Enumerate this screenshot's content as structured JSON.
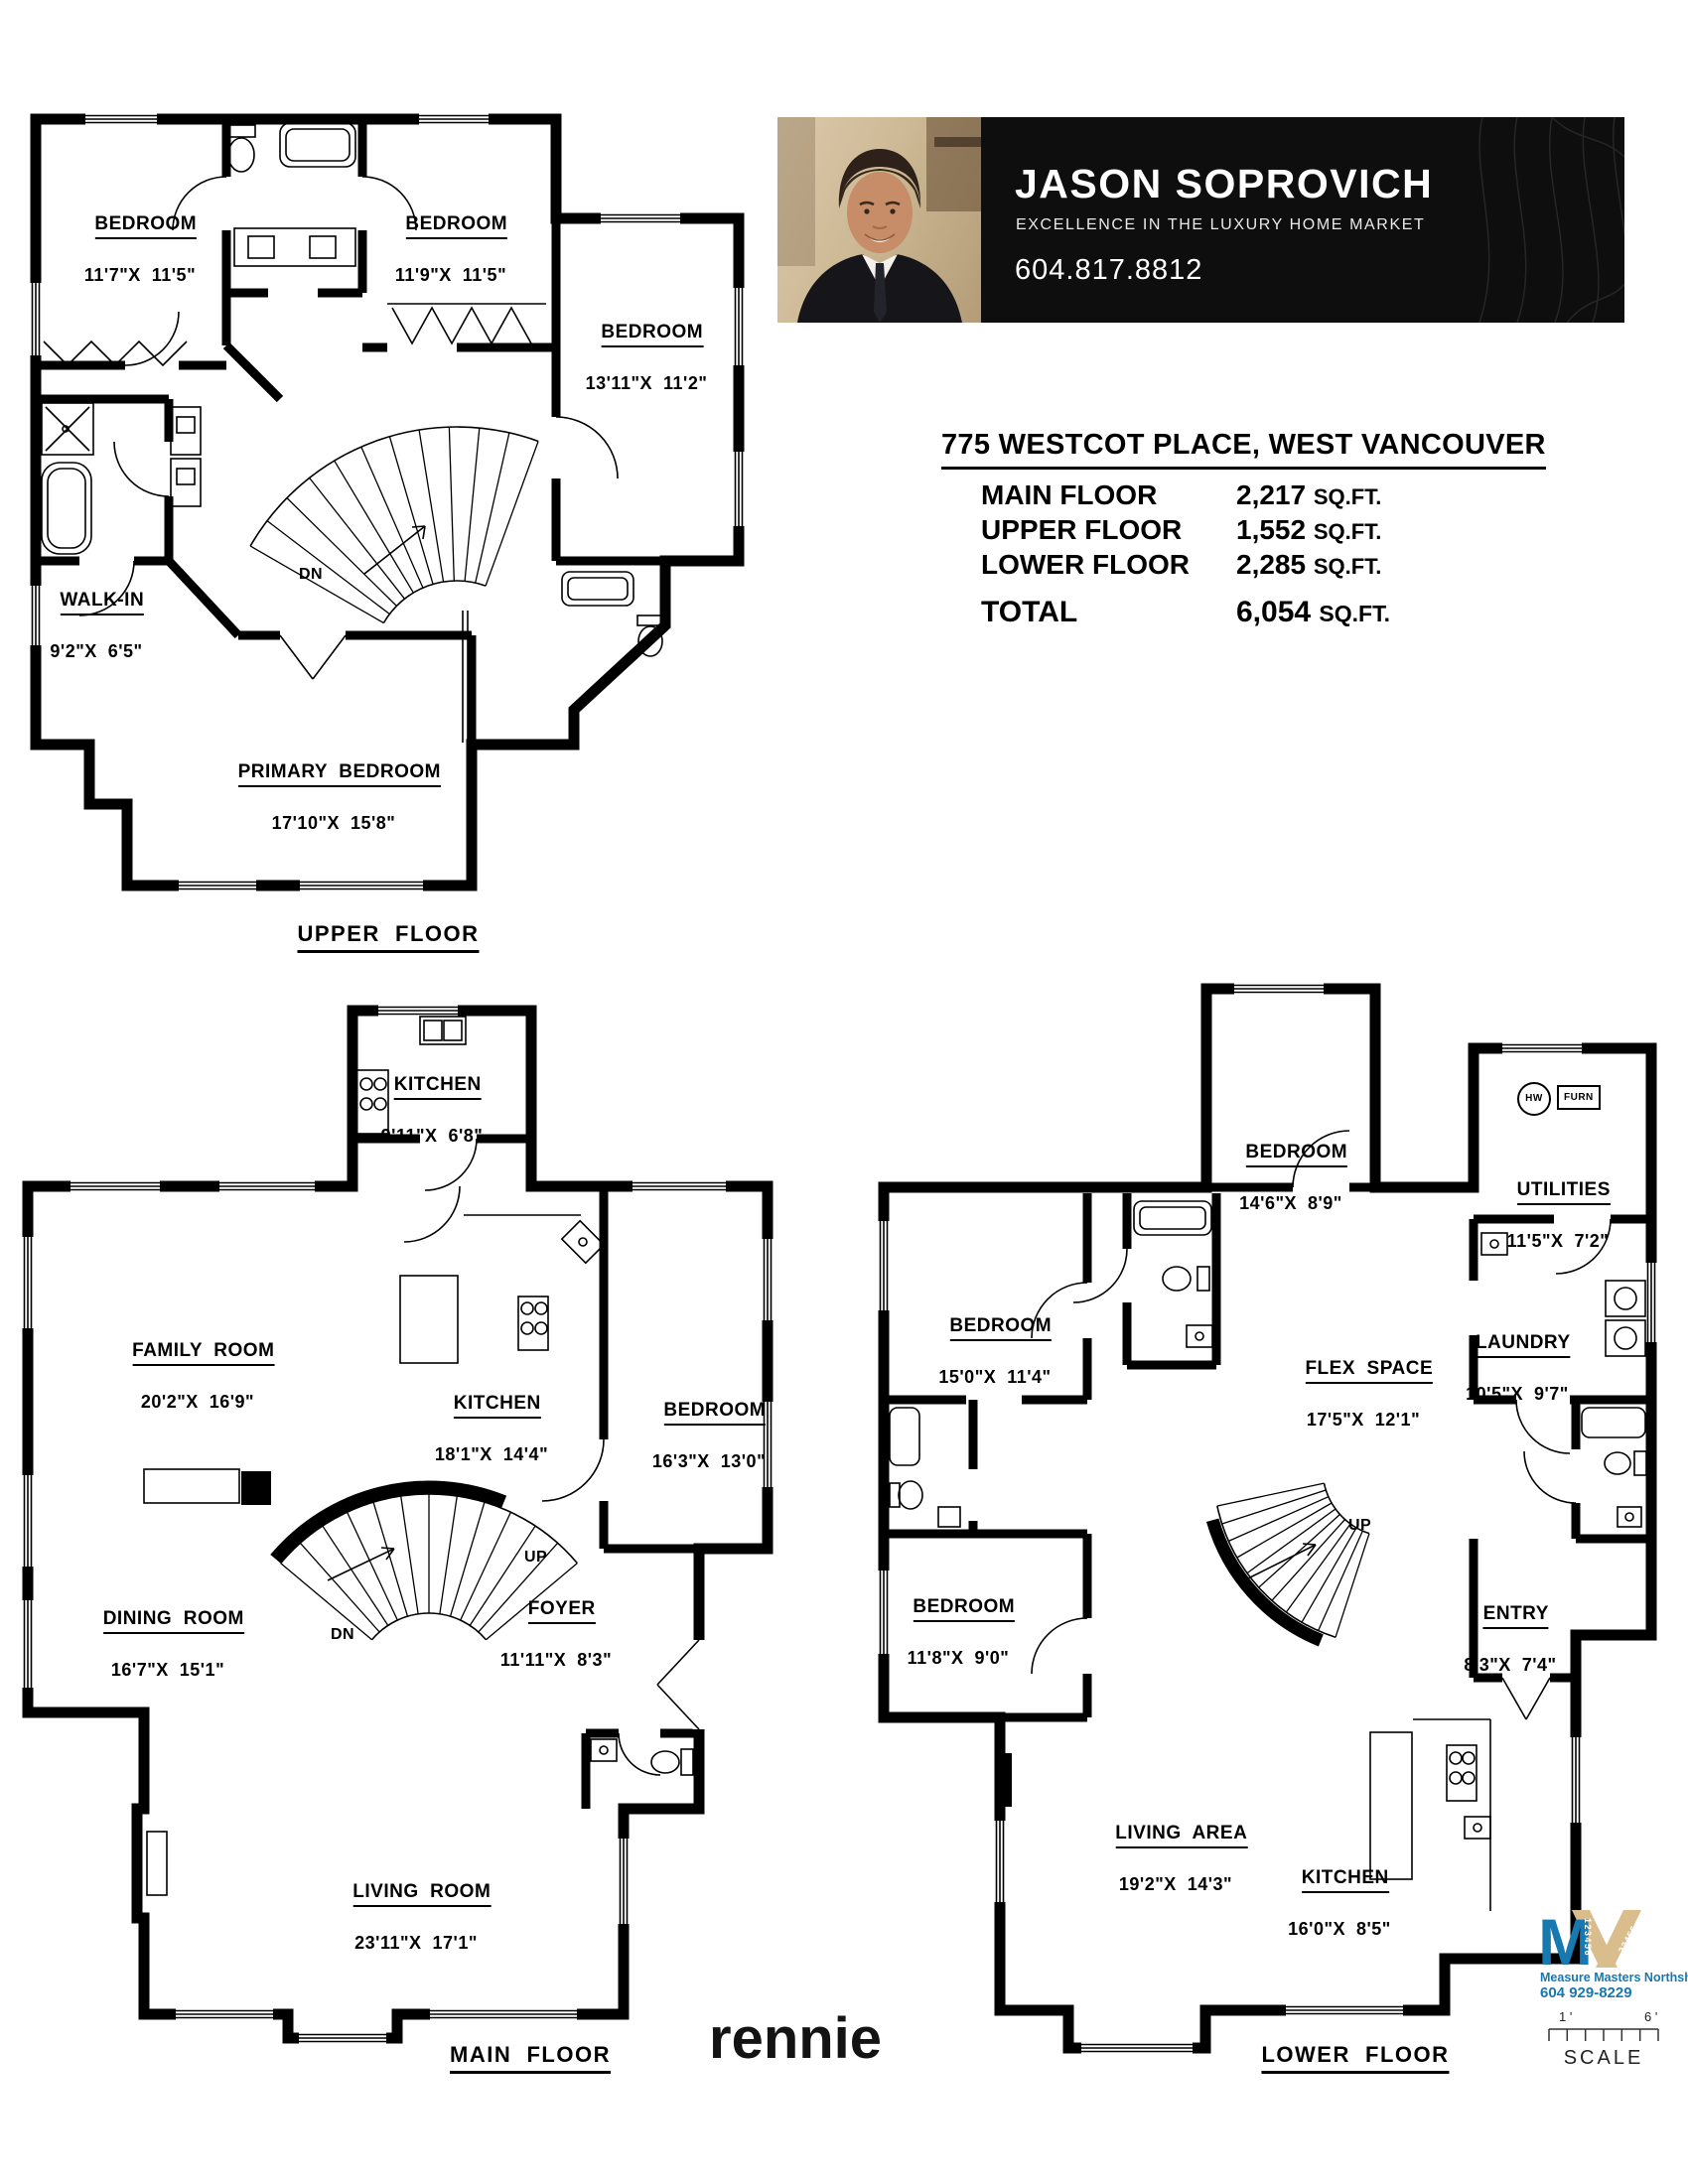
{
  "banner": {
    "name": "JASON SOPROVICH",
    "tagline": "EXCELLENCE IN THE LUXURY HOME MARKET",
    "phone": "604.817.8812"
  },
  "property": {
    "address": "775 WESTCOT PLACE, WEST VANCOUVER",
    "areas": [
      {
        "label": "MAIN FLOOR",
        "value": "2,217",
        "unit": "SQ.FT."
      },
      {
        "label": "UPPER FLOOR",
        "value": "1,552",
        "unit": "SQ.FT."
      },
      {
        "label": "LOWER FLOOR",
        "value": "2,285",
        "unit": "SQ.FT."
      }
    ],
    "total": {
      "label": "TOTAL",
      "value": "6,054",
      "unit": "SQ.FT."
    }
  },
  "floors": {
    "upper": {
      "caption": "UPPER  FLOOR",
      "dn": "DN",
      "rooms": [
        {
          "label": "BEDROOM",
          "dims": "11'7\"X  11'5\""
        },
        {
          "label": "BEDROOM",
          "dims": "11'9\"X  11'5\""
        },
        {
          "label": "BEDROOM",
          "dims": "13'11\"X  11'2\""
        },
        {
          "label": "WALK-IN",
          "dims": "9'2\"X  6'5\""
        },
        {
          "label": "PRIMARY  BEDROOM",
          "dims": "17'10\"X  15'8\""
        }
      ]
    },
    "main": {
      "caption": "MAIN  FLOOR",
      "up": "UP",
      "dn": "DN",
      "rooms": [
        {
          "label": "KITCHEN",
          "dims": "9'11\"X  6'8\""
        },
        {
          "label": "FAMILY  ROOM",
          "dims": "20'2\"X  16'9\""
        },
        {
          "label": "KITCHEN",
          "dims": "18'1\"X  14'4\""
        },
        {
          "label": "BEDROOM",
          "dims": "16'3\"X  13'0\""
        },
        {
          "label": "DINING  ROOM",
          "dims": "16'7\"X  15'1\""
        },
        {
          "label": "FOYER",
          "dims": "11'11\"X  8'3\""
        },
        {
          "label": "LIVING  ROOM",
          "dims": "23'11\"X  17'1\""
        }
      ]
    },
    "lower": {
      "caption": "LOWER  FLOOR",
      "up": "UP",
      "hw": "HW",
      "furn": "FURN",
      "rooms": [
        {
          "label": "BEDROOM",
          "dims": "14'6\"X  8'9\""
        },
        {
          "label": "UTILITIES",
          "dims": "11'5\"X  7'2\""
        },
        {
          "label": "BEDROOM",
          "dims": "15'0\"X  11'4\""
        },
        {
          "label": "FLEX  SPACE",
          "dims": "17'5\"X  12'1\""
        },
        {
          "label": "LAUNDRY",
          "dims": "10'5\"X  9'7\""
        },
        {
          "label": "BEDROOM",
          "dims": "11'8\"X  9'0\""
        },
        {
          "label": "ENTRY",
          "dims": "8'3\"X  7'4\""
        },
        {
          "label": "LIVING  AREA",
          "dims": "19'2\"X  14'3\""
        },
        {
          "label": "KITCHEN",
          "dims": "16'0\"X  8'5\""
        }
      ]
    }
  },
  "footer": {
    "brand": "rennie"
  },
  "surveyor": {
    "company": "Measure Masters Northshore",
    "phone": "604 929-8229",
    "scale_label": "SCALE",
    "tick_left": "1 '",
    "tick_right": "6 '",
    "logo_letter": "M",
    "logo_digits": "123456"
  },
  "colors": {
    "banner_bg": "#0e0e0e",
    "logo_blue": "#1878b0",
    "logo_tan": "#d9bd8d"
  }
}
